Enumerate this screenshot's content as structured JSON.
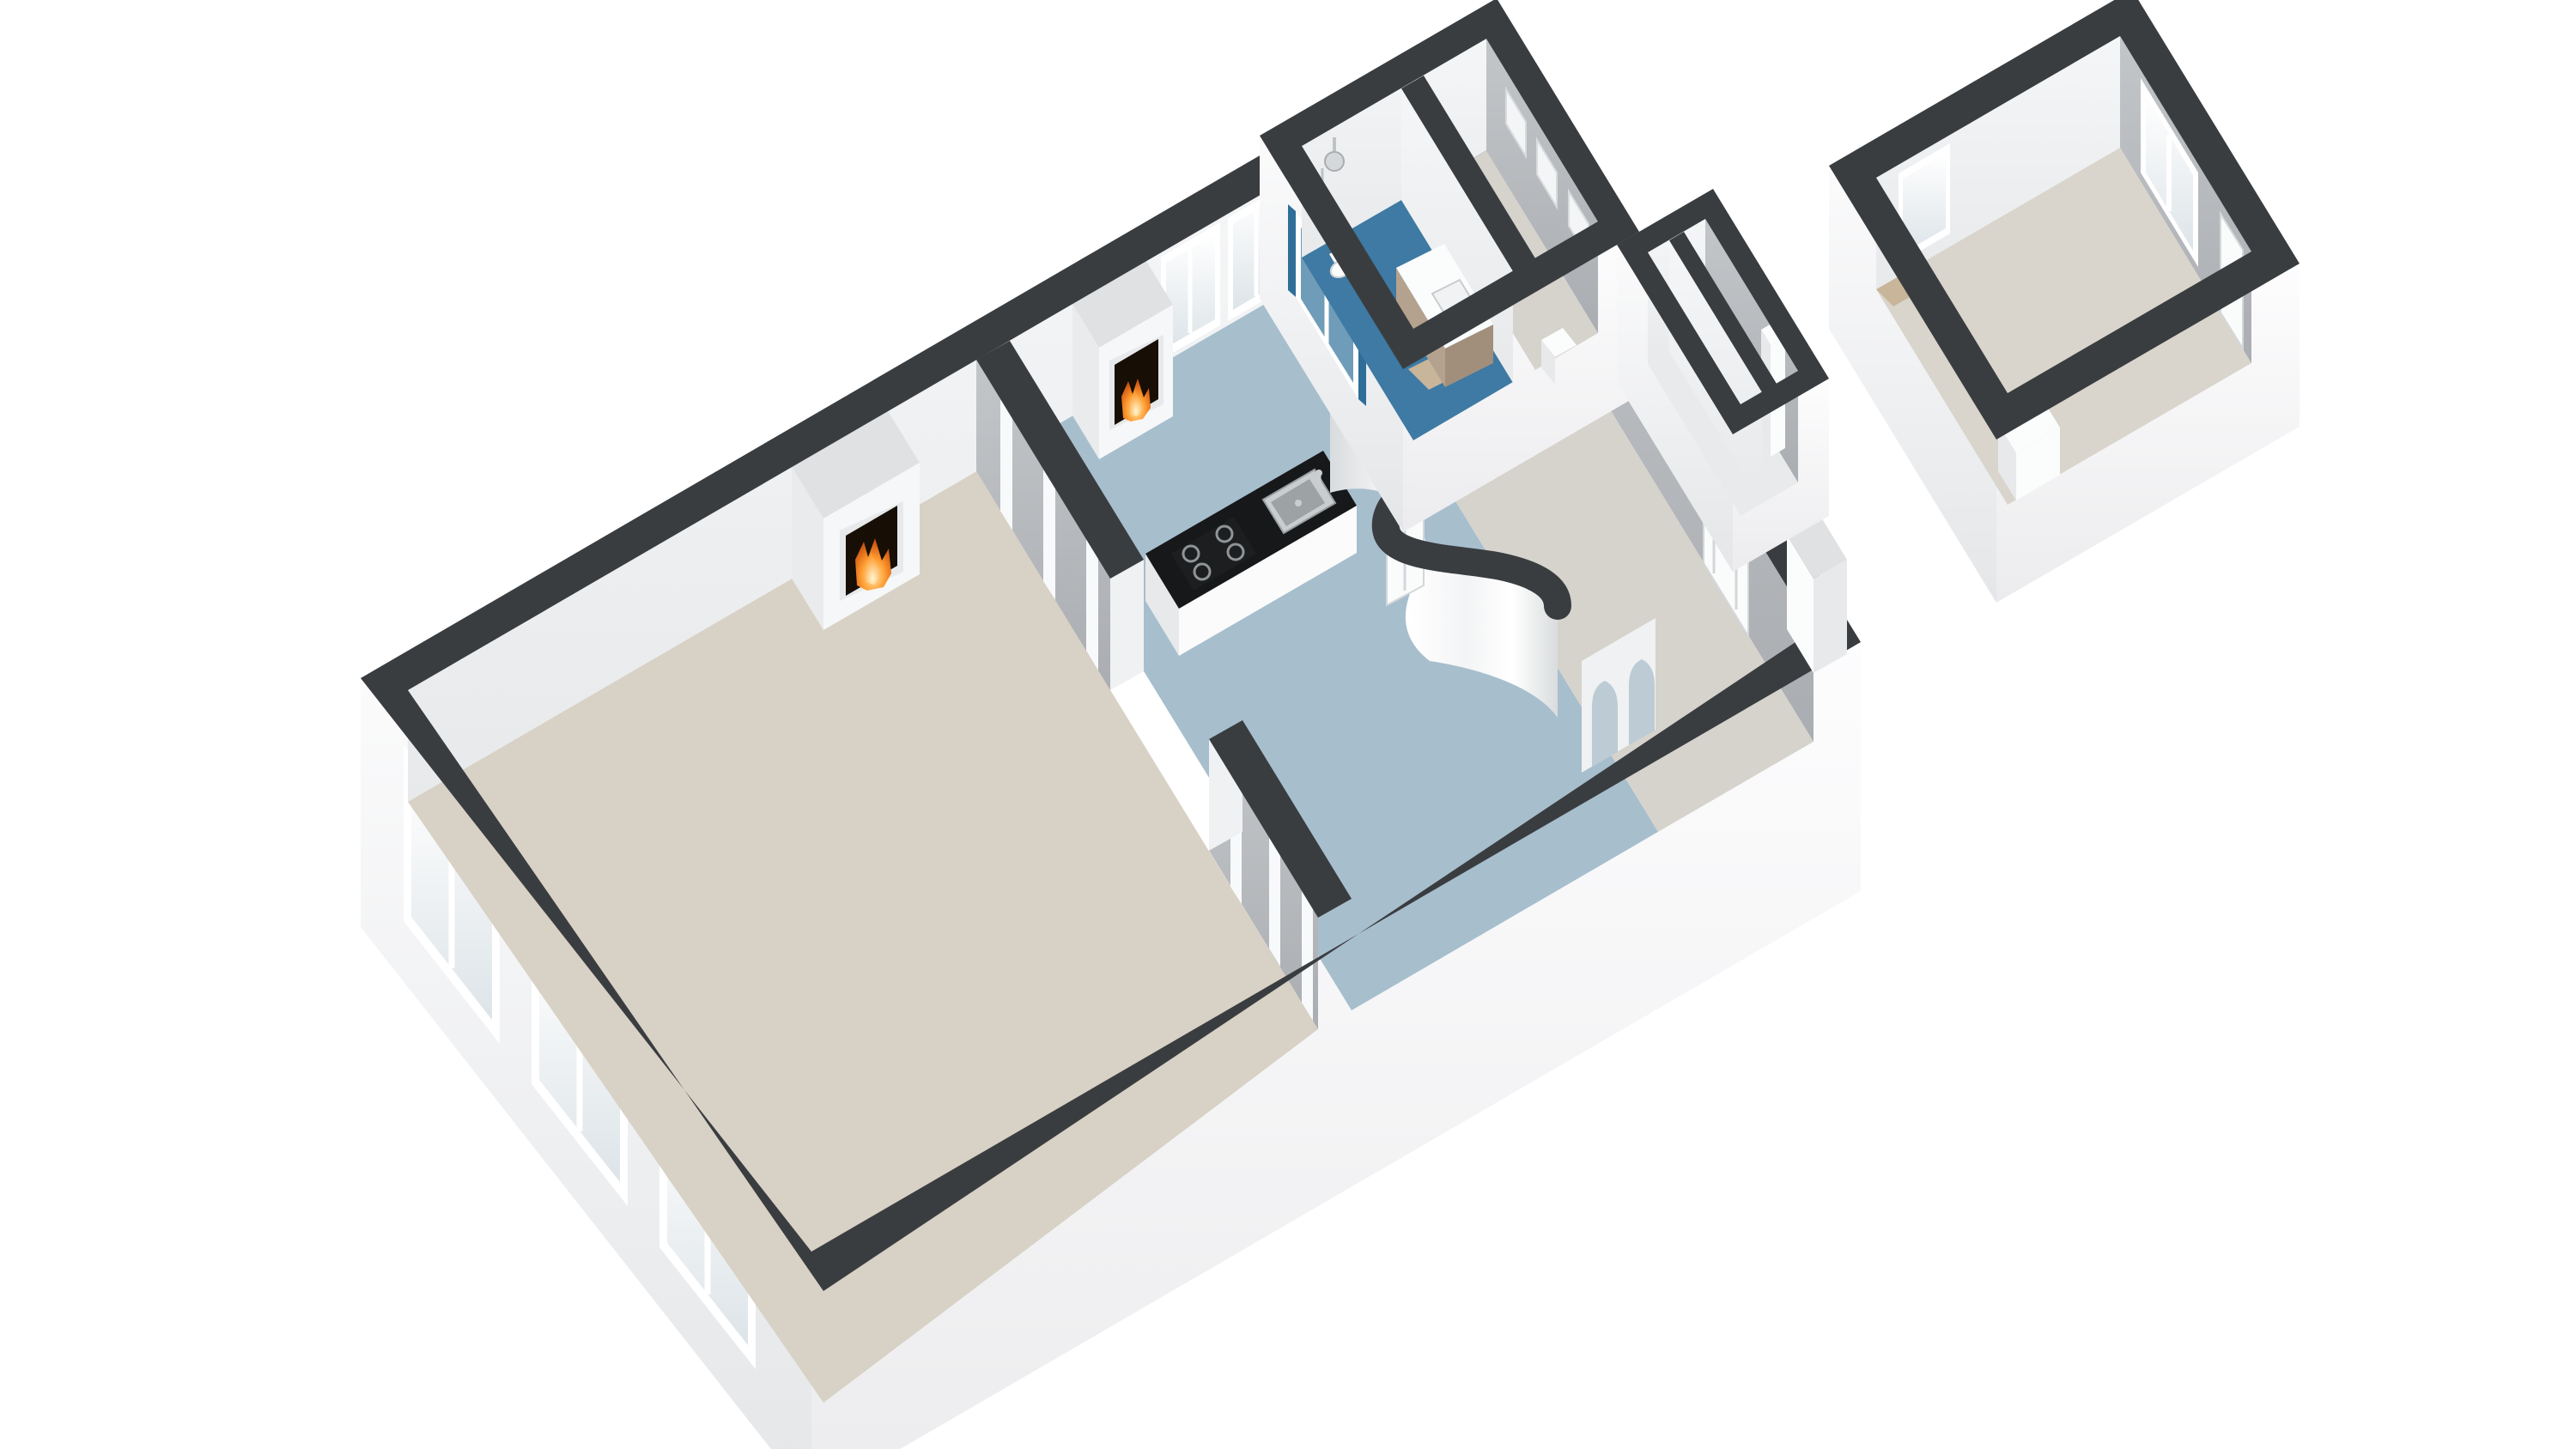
{
  "app": {
    "kind": "3d-floorplan-render",
    "background": "#ffffff"
  },
  "colors": {
    "background": "#ffffff",
    "wallTop": "#3a3d40",
    "wallGapTop": "#eef0f1",
    "wallEndFace": "#eff1f2",
    "extTop": "#fbfbfc",
    "extBottom": "#e4e6e8",
    "extBrightTop": "#fdfdfe",
    "extBrightBottom": "#ececee",
    "intLightTop": "#f5f6f7",
    "intLightBottom": "#e7e9eb",
    "intGrayTop": "#c3c6c9",
    "intGrayBottom": "#aaadb1",
    "floorLiving": "#d8d1c5",
    "floorKitchen": "#a7becd",
    "floorHall": "#d6d3cd",
    "floorBathroom": "#3e7aa3",
    "floorDetachedRoom": "#d9d5cc",
    "floorCloset": "#e9eaeb",
    "windowFrame": "#ffffff",
    "glassTop": "#ffffff",
    "glassBottom": "#dde4e8",
    "glassBlue": "#6f9cb8",
    "blueWall": "#2f6e99",
    "counterTop": "#17181a",
    "counterBase": "#fbfbfc",
    "steel": "#c9cdcf",
    "steelEdge": "#9aa0a3",
    "hobBlack": "#1d1e20",
    "burnerSteel": "#8f9497",
    "chimneyFace": "#f6f7f8",
    "chimneyTop": "#dfe1e3",
    "chimneySide": "#e9ebec",
    "fireDark": "#170e05",
    "flameCore": "#ffe9a8",
    "flameMid": "#ff9b2f",
    "flameDeep": "#b93c08",
    "doorWhite": "#fafbfb",
    "doorEdge": "#d4d7d9",
    "vanityWood": "#b5a28e",
    "vanityWoodDark": "#a28f7b",
    "fixtureWhite": "#fbfcfc",
    "fixtureShade": "#e7e9ea",
    "bathMat": "#c9b59a",
    "nicheWhite": "#f4f5f6",
    "nicheFrame": "#d9dcde",
    "pilaster": "#f8f9fa",
    "archOpening": "#bccbd4",
    "curveTopShade": "#f3f4f5",
    "curveBottomShade": "#d9dcde"
  },
  "scene": {
    "projection": "isometric-3d",
    "rooms": [
      {
        "id": "living-room",
        "floor": "floorLiving",
        "features": [
          "bay-windows-3",
          "fireplace",
          "ensuite-partition"
        ]
      },
      {
        "id": "kitchen",
        "floor": "floorKitchen",
        "features": [
          "fireplace",
          "counter-with-sink-and-hob",
          "two-tall-windows",
          "curved-wall",
          "arched-openings"
        ]
      },
      {
        "id": "hall",
        "floor": "floorHall",
        "features": [
          "rear-door",
          "closets"
        ]
      },
      {
        "id": "bathroom",
        "floor": "floorBathroom",
        "features": [
          "shower",
          "vanity",
          "toilet",
          "window",
          "blue-walls"
        ]
      },
      {
        "id": "laundry-room",
        "floor": "floorHall",
        "features": [
          "wall-niches"
        ]
      },
      {
        "id": "detached-room",
        "floor": "floorDetachedRoom",
        "features": [
          "window",
          "double-window",
          "door",
          "storage-box"
        ]
      }
    ],
    "fixtures": [
      "living-room-fireplace",
      "kitchen-fireplace",
      "kitchen-sink",
      "kitchen-hob",
      "shower-head",
      "bathroom-vanity",
      "toilet",
      "bath-mat",
      "wall-niche-1",
      "wall-niche-2",
      "wall-niche-3",
      "closet-column",
      "chimney-pillar",
      "storage-box"
    ]
  }
}
